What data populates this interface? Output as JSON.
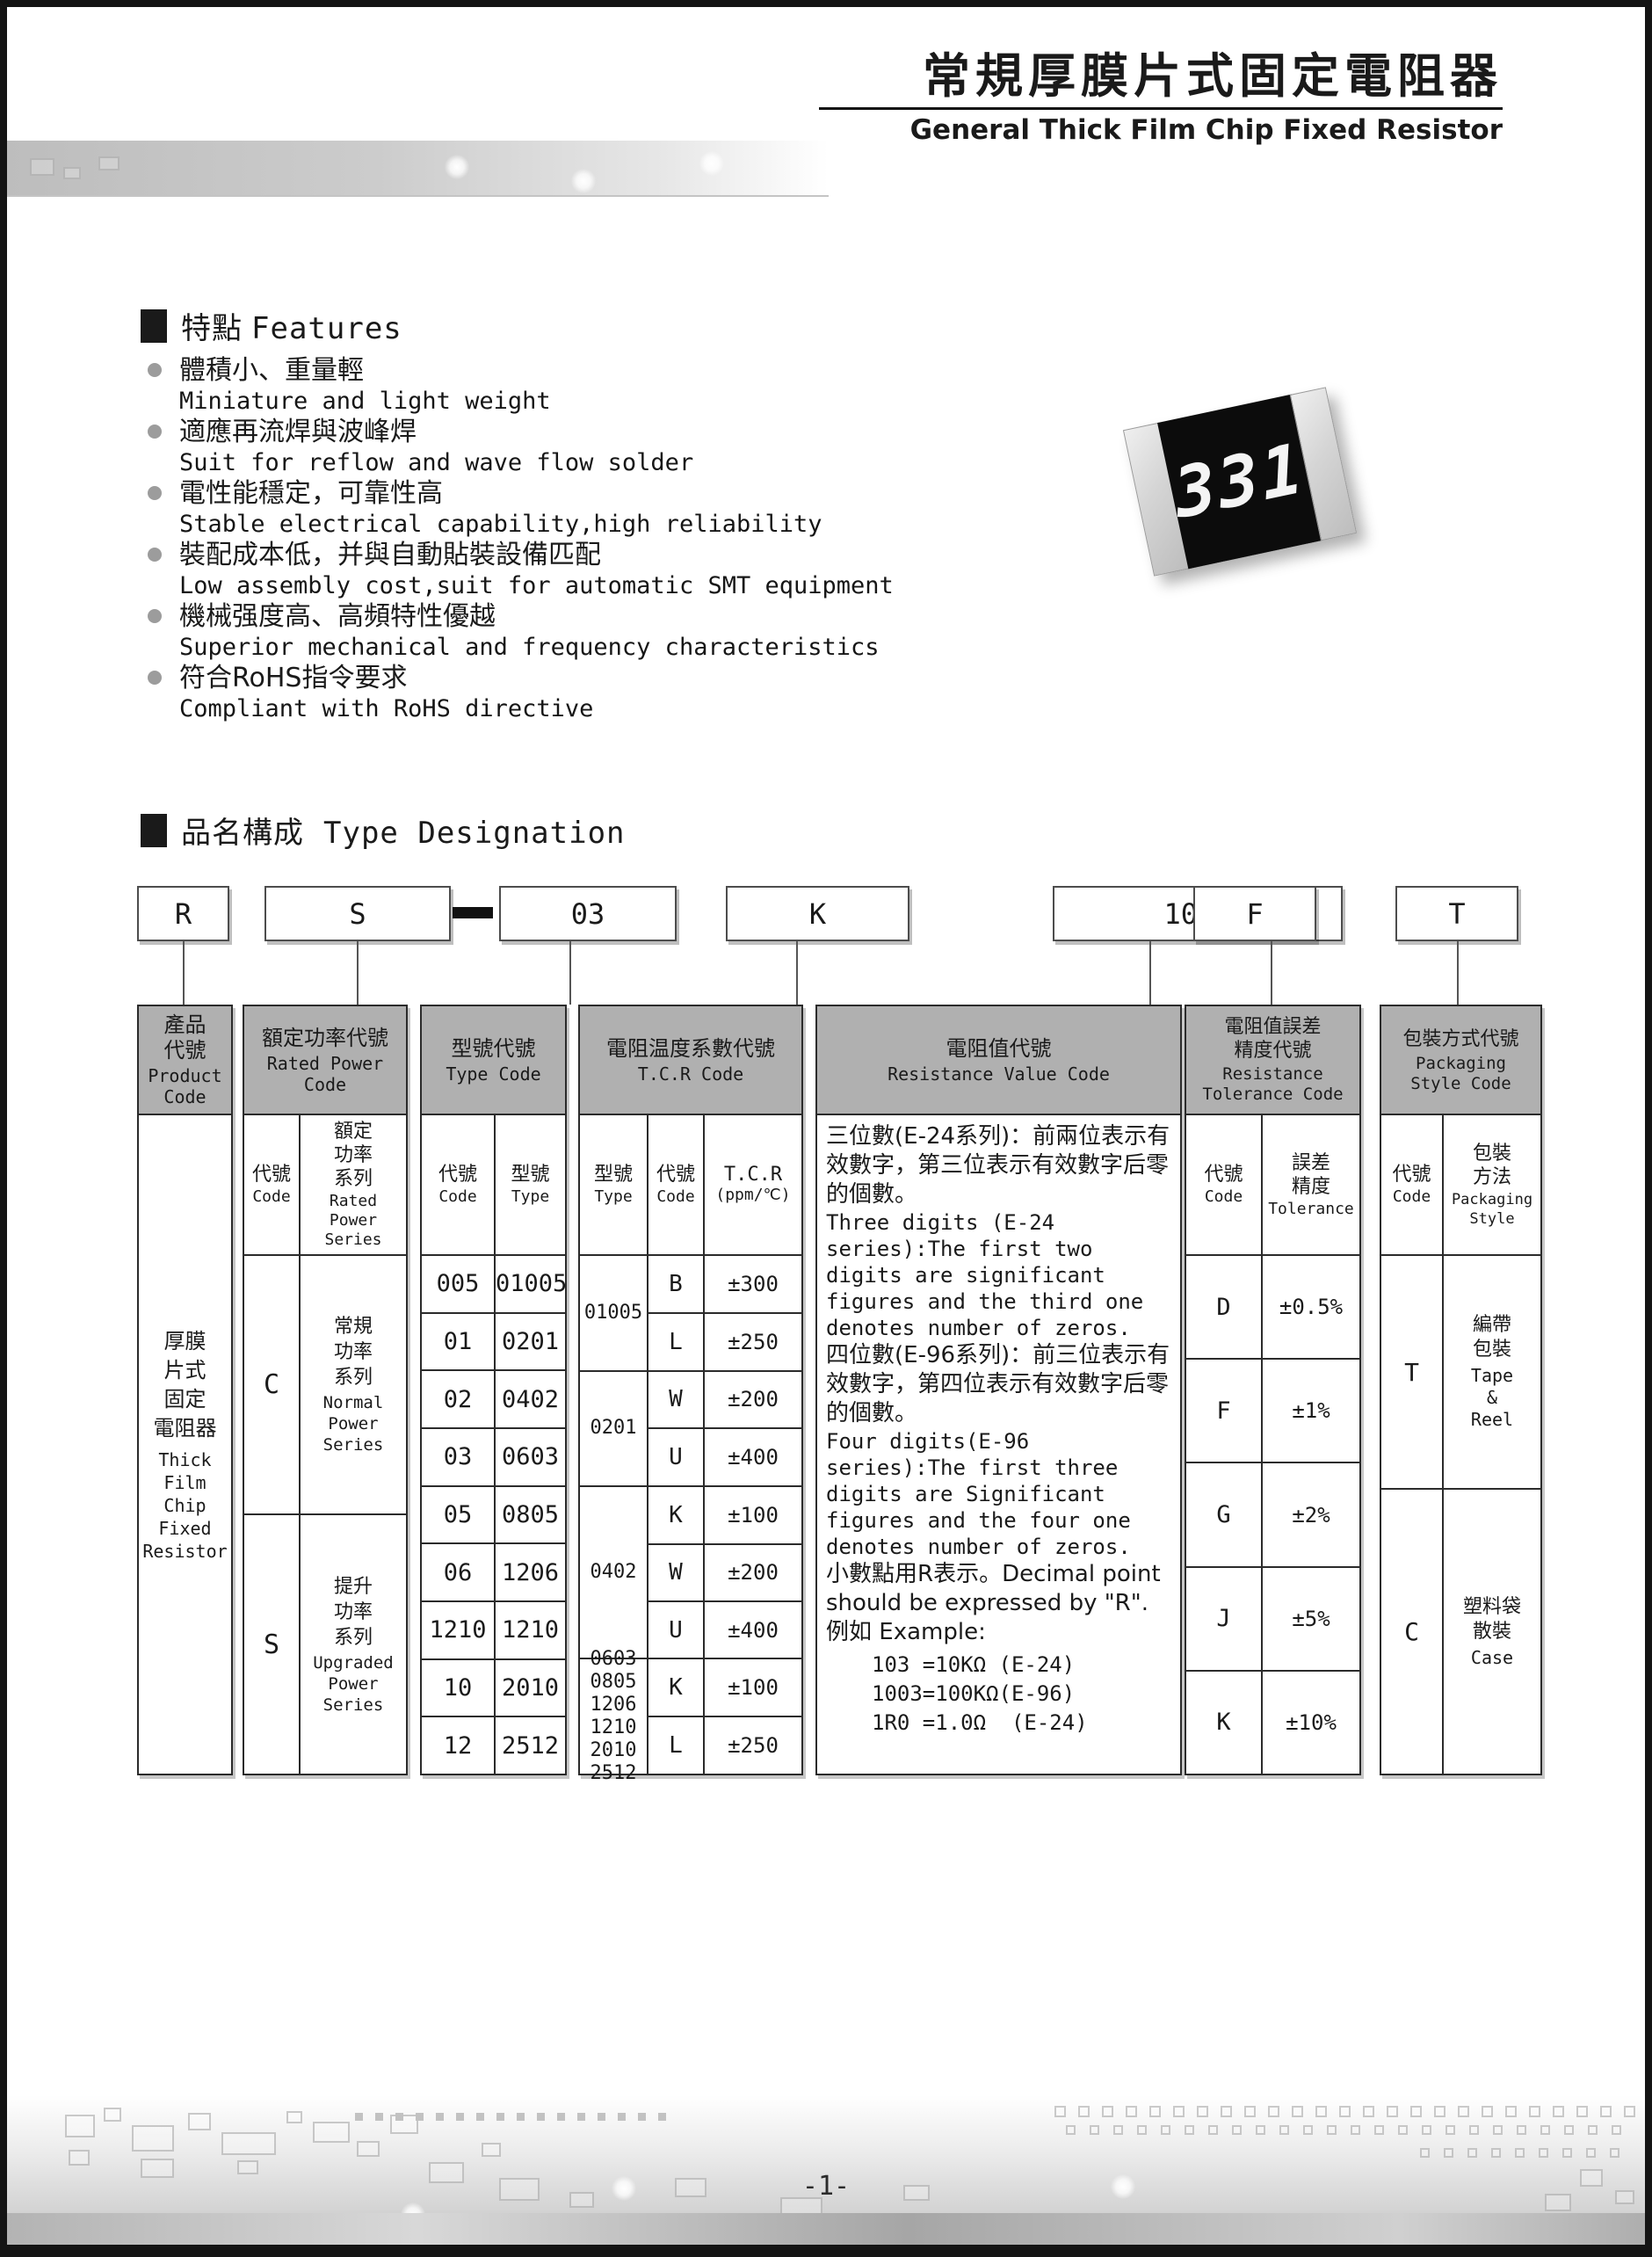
{
  "header": {
    "title_cn": "常規厚膜片式固定電阻器",
    "title_en": "General Thick Film Chip Fixed Resistor"
  },
  "features": {
    "heading_cn": "特點",
    "heading_en": "Features",
    "items": [
      {
        "cn": "體積小、重量輕",
        "en": "Miniature and light weight"
      },
      {
        "cn": "適應再流焊與波峰焊",
        "en": "Suit for reflow and wave flow solder"
      },
      {
        "cn": "電性能穩定，可靠性高",
        "en": "Stable electrical capability,high reliability"
      },
      {
        "cn": "裝配成本低，并與自動貼裝設備匹配",
        "en": "Low assembly cost,suit for automatic SMT equipment"
      },
      {
        "cn": "機械强度高、高頻特性優越",
        "en": "Superior mechanical and frequency characteristics"
      },
      {
        "cn": "符合RoHS指令要求",
        "en": "Compliant with RoHS directive"
      }
    ]
  },
  "chip": {
    "label": "331"
  },
  "type_designation": {
    "heading_cn": "品名構成",
    "heading_en": "Type Designation",
    "codes": [
      "R",
      "S",
      "03",
      "K",
      "1003",
      "F",
      "T"
    ]
  },
  "table": {
    "product": {
      "header_cn": "產品\n代號",
      "header_en": "Product\nCode",
      "body_cn": "厚膜\n片式\n固定\n電阻器",
      "body_en": "Thick\nFilm\nChip\nFixed\nResistor"
    },
    "rated_power": {
      "header_cn": "額定功率代號",
      "header_en": "Rated Power\nCode",
      "col1_cn": "代號",
      "col1_en": "Code",
      "col2_cn": "額定\n功率\n系列",
      "col2_en": "Rated\nPower\nSeries",
      "rows": [
        {
          "code": "C",
          "cn": "常規\n功率\n系列",
          "en": "Normal\nPower\nSeries"
        },
        {
          "code": "S",
          "cn": "提升\n功率\n系列",
          "en": "Upgraded\nPower\nSeries"
        }
      ]
    },
    "type_code": {
      "header_cn": "型號代號",
      "header_en": "Type Code",
      "col1_cn": "代號",
      "col1_en": "Code",
      "col2_cn": "型號",
      "col2_en": "Type",
      "rows": [
        [
          "005",
          "01005"
        ],
        [
          "01",
          "0201"
        ],
        [
          "02",
          "0402"
        ],
        [
          "03",
          "0603"
        ],
        [
          "05",
          "0805"
        ],
        [
          "06",
          "1206"
        ],
        [
          "1210",
          "1210"
        ],
        [
          "10",
          "2010"
        ],
        [
          "12",
          "2512"
        ]
      ]
    },
    "tcr": {
      "header_cn": "電阻温度系數代號",
      "header_en": "T.C.R Code",
      "col1_cn": "型號",
      "col1_en": "Type",
      "col2_cn": "代號",
      "col2_en": "Code",
      "col3": "T.C.R",
      "col3b": "(ppm/℃)",
      "groups": [
        {
          "type": "01005",
          "rows": [
            [
              "B",
              "±300"
            ],
            [
              "L",
              "±250"
            ]
          ]
        },
        {
          "type": "0201",
          "rows": [
            [
              "W",
              "±200"
            ],
            [
              "U",
              "±400"
            ]
          ]
        },
        {
          "type": "0402",
          "rows": [
            [
              "K",
              "±100"
            ],
            [
              "W",
              "±200"
            ],
            [
              "U",
              "±400"
            ]
          ]
        },
        {
          "type": "0603\n0805\n1206\n1210\n2010\n2512",
          "rows": [
            [
              "K",
              "±100"
            ],
            [
              "L",
              "±250"
            ]
          ]
        }
      ]
    },
    "resistance_value": {
      "header_cn": "電阻值代號",
      "header_en": "Resistance Value Code",
      "cn1": "三位數(E-24系列)：前兩位表示有效數字，第三位表示有效數字后零的個數。",
      "en1": "Three digits (E-24 series):The first two digits are significant figures and the third one denotes number of zeros.",
      "cn2": "四位數(E-96系列)：前三位表示有效數字，第四位表示有效數字后零的個數。",
      "en2": "Four digits(E-96 series):The first three digits are Significant figures and the four one denotes number of zeros.",
      "mix": "小數點用R表示。Decimal point should be expressed by \"R\".",
      "example_label": "例如 Example:",
      "examples": [
        "103 =10KΩ (E-24)",
        "1003=100KΩ(E-96)",
        "1R0 =1.0Ω  (E-24)"
      ]
    },
    "tolerance": {
      "header_cn": "電阻值誤差\n精度代號",
      "header_en": "Resistance\nTolerance Code",
      "col1_cn": "代號",
      "col1_en": "Code",
      "col2_cn": "誤差\n精度",
      "col2_en": "Tolerance",
      "rows": [
        [
          "D",
          "±0.5%"
        ],
        [
          "F",
          "±1%"
        ],
        [
          "G",
          "±2%"
        ],
        [
          "J",
          "±5%"
        ],
        [
          "K",
          "±10%"
        ]
      ]
    },
    "packaging": {
      "header_cn": "包裝方式代號",
      "header_en": "Packaging\nStyle Code",
      "col1_cn": "代號",
      "col1_en": "Code",
      "col2_cn": "包裝\n方法",
      "col2_en": "Packaging\nStyle",
      "rows": [
        {
          "code": "T",
          "cn": "編帶\n包裝",
          "en": "Tape\n&\nReel"
        },
        {
          "code": "C",
          "cn": "塑料袋\n散裝",
          "en": "Case"
        }
      ]
    }
  },
  "footer": {
    "page": "-1-"
  }
}
